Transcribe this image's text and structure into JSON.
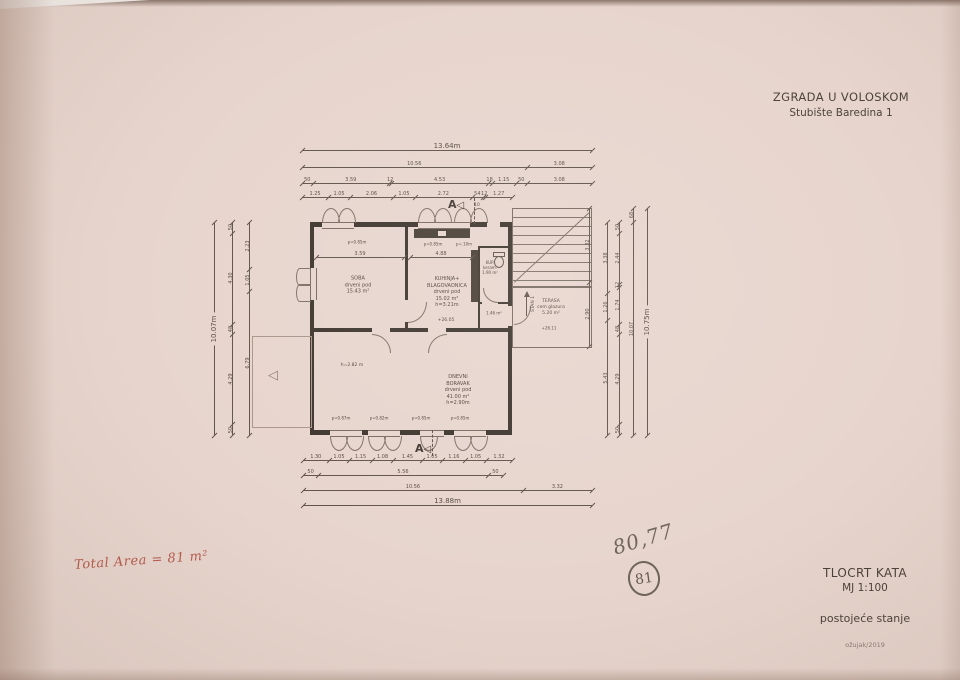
{
  "header": {
    "title": "ZGRADA U VOLOSKOM",
    "subtitle": "Stubište Baredina 1"
  },
  "title_block": {
    "drawing_name": "TLOCRT KATA",
    "scale": "MJ 1:100",
    "state": "postojeće stanje",
    "date": "ožujak/2019"
  },
  "handwriting": {
    "red_note": "Total Area = 81 m²",
    "pencil_number": "80,77",
    "pencil_circled": "81"
  },
  "section_marker": {
    "letter": "A",
    "triangle": "◁"
  },
  "symbols": {
    "garage_triangle": "◁"
  },
  "plan_labels": {
    "soba": [
      "SOBA",
      "drveni pod",
      "15.43 m²"
    ],
    "kuhinja": [
      "KUHINJA+",
      "BLAGOVAONICA",
      "drveni pod",
      "15.02 m²",
      "h=3.21m"
    ],
    "dnevni": [
      "DNEVNI",
      "BORAVAK",
      "drveni pod",
      "41.00 m²",
      "h=2.90m"
    ],
    "terasa": [
      "TERASA",
      "cem glazura",
      "5.20 m²"
    ],
    "kup": [
      "KUP.",
      "keram.",
      "1.90 m²"
    ],
    "hodnik_area": [
      "1.46 m²"
    ],
    "h_left": [
      "h=2.82 m"
    ],
    "level_kitchen": [
      "+26.05"
    ],
    "level_terrace": [
      "+26.11"
    ],
    "stan": [
      "STAN 1"
    ],
    "p_top_1": [
      "p=0.85m"
    ],
    "p_top_2": [
      "p=0.85m"
    ],
    "p_top_3": [
      "p=.10m"
    ],
    "p_bot_1": [
      "p=0.87m"
    ],
    "p_bot_2": [
      "p=0.82m"
    ],
    "p_bot_3": [
      "p=0.85m"
    ],
    "p_bot_4": [
      "p=0.85m"
    ],
    "ten": [
      "10"
    ]
  },
  "dim_chains": {
    "t1": [
      "13.64m"
    ],
    "t2": [
      "10.56",
      "3.08"
    ],
    "t3": [
      "50",
      "3.59",
      "12",
      "4.53",
      "18",
      "1.15",
      "50",
      "3.08"
    ],
    "t4": [
      "1.25",
      "1.05",
      "2.06",
      "1.05",
      "2.72",
      "54",
      "12",
      "1.27"
    ],
    "b1": [
      "1.30",
      "1.05",
      "1.15",
      "1.08",
      "1.45",
      "1.05",
      "1.16",
      "1.05",
      "1.32"
    ],
    "b2": [
      "50",
      "5.56",
      "50"
    ],
    "b3": [
      "10.56",
      "3.32"
    ],
    "b4": [
      "13.88m"
    ],
    "l1": [
      "10.07m"
    ],
    "l2": [
      "50",
      "4.30",
      "48",
      "4.29",
      "50"
    ],
    "l3": [
      "2.23",
      "1.05",
      "6.79"
    ],
    "r0": [
      "3.32",
      "2.90"
    ],
    "r1": [
      "3.38",
      "1.26",
      "5.43"
    ],
    "r2": [
      "50",
      "2.44",
      "12",
      "1.74",
      "48",
      "4.29",
      "50"
    ],
    "r3": [
      "68",
      "10.07"
    ],
    "r4": [
      "10.75m"
    ],
    "s1": [
      "3.59"
    ],
    "s2": [
      "4.88"
    ]
  }
}
